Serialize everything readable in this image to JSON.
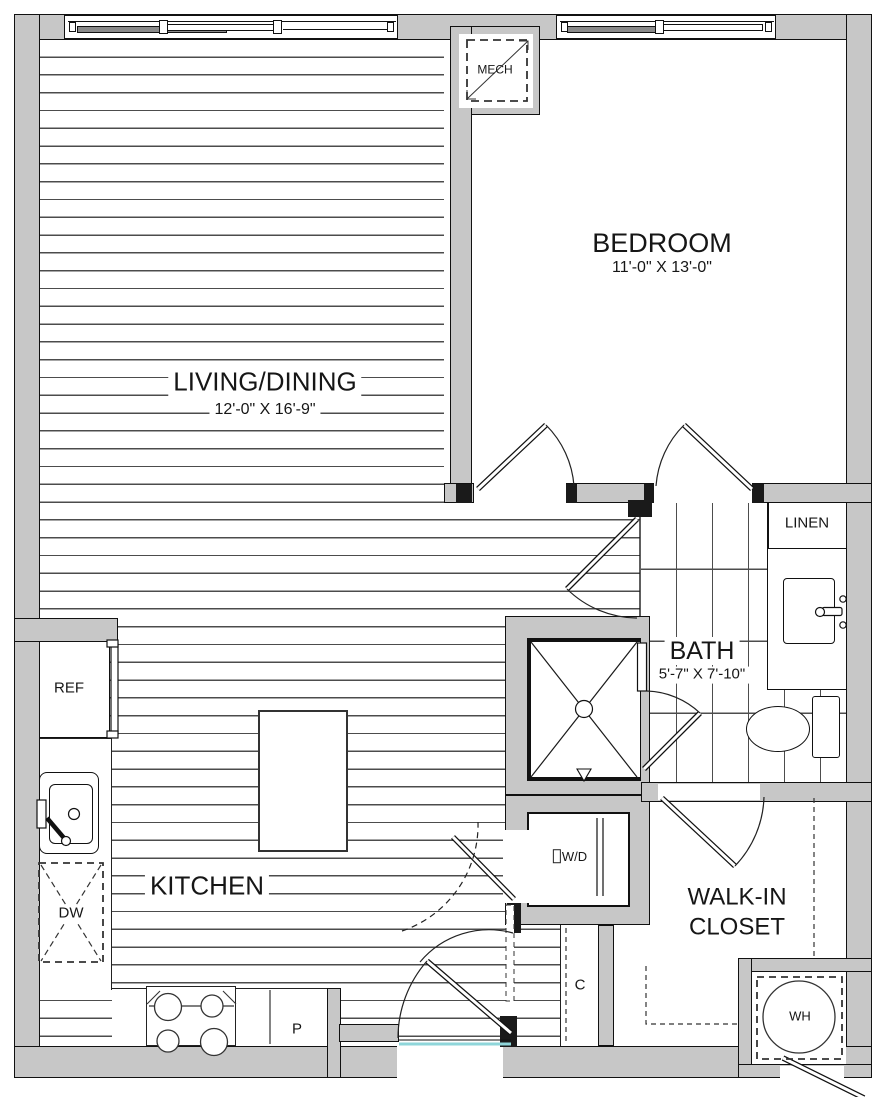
{
  "plan_title": "One-bedroom apartment floor plan",
  "rooms": {
    "living": {
      "name": "LIVING/DINING",
      "dims": "12'-0\" X 16'-9\""
    },
    "bedroom": {
      "name": "BEDROOM",
      "dims": "11'-0\" X 13'-0\""
    },
    "bath": {
      "name": "BATH",
      "dims": "5'-7\" X 7'-10\""
    },
    "kitchen": {
      "name": "KITCHEN"
    },
    "walkin": {
      "line1": "WALK-IN",
      "line2": "CLOSET"
    }
  },
  "fixtures": {
    "mech": "MECH",
    "linen": "LINEN",
    "refrigerator": "REF",
    "dishwasher": "DW",
    "washer_dryer": "W/D",
    "coat_closet": "C",
    "pantry": "P",
    "water_heater": "WH"
  },
  "colors": {
    "wall_fill": "#c7c7c7",
    "wall_line": "#111111",
    "floor_line": "#4c4c4c",
    "threshold": "#8fd6da"
  }
}
